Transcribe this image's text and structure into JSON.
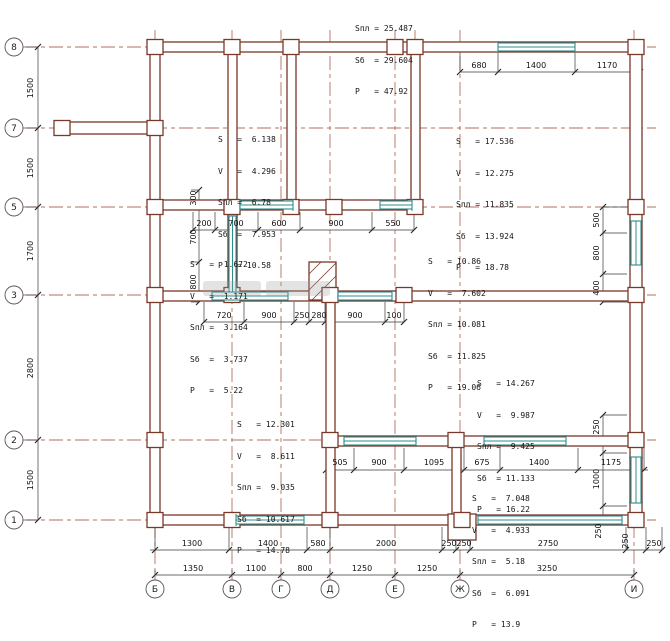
{
  "colors": {
    "wall": "#7a382a",
    "axis_line": "#b2705c",
    "window": "#2c8c8c",
    "dimension": "#3a3a3a"
  },
  "axes": {
    "left": [
      "8",
      "7",
      "5",
      "3",
      "2",
      "1"
    ],
    "bottom": [
      "Б",
      "В",
      "Г",
      "Д",
      "Е",
      "Ж",
      "И"
    ]
  },
  "dims": {
    "top": [
      "680",
      "1400",
      "1170"
    ],
    "row5": [
      "200",
      "700",
      "600",
      "900",
      "550"
    ],
    "row3": [
      "720",
      "900",
      "250",
      "280",
      "900",
      "100"
    ],
    "row2": [
      "505",
      "900",
      "1095",
      "675",
      "1400",
      "1175"
    ],
    "bottom1": [
      "1300",
      "1400",
      "580",
      "2000",
      "250",
      "250",
      "2750",
      "250"
    ],
    "bottom2": [
      "1350",
      "1100",
      "800",
      "1250",
      "1250",
      "3250"
    ],
    "left": [
      "1500",
      "1500",
      "1700",
      "2800",
      "1500"
    ],
    "leftMid": [
      "300",
      "700",
      "800"
    ],
    "rightTop": [
      "500",
      "800",
      "400"
    ],
    "rightBottom": [
      "250",
      "1000",
      "250"
    ],
    "rotE": "250"
  },
  "annotations": [
    {
      "name": "totals",
      "lines": [
        "Sпл = 25.487",
        "Sб  = 29.604",
        "P   = 47.92"
      ]
    },
    {
      "name": "room-1",
      "lines": [
        "S   =  6.138",
        "V   =  4.296",
        "Sпл =  6.78",
        "Sб  =  7.953",
        "P   = 10.58"
      ]
    },
    {
      "name": "room-2",
      "lines": [
        "S   = 17.536",
        "V   = 12.275",
        "Sпл = 11.835",
        "Sб  = 13.924",
        "P   = 18.78"
      ]
    },
    {
      "name": "room-3",
      "lines": [
        "S   =  1.672",
        "V   =  1.171",
        "Sпл =  3.164",
        "Sб  =  3.737",
        "P   =  5.22"
      ]
    },
    {
      "name": "room-4",
      "lines": [
        "S   = 10.86",
        "V   =  7.602",
        "Sпл = 10.081",
        "Sб  = 11.825",
        "P   = 19.06"
      ]
    },
    {
      "name": "room-5",
      "lines": [
        "S   = 14.267",
        "V   =  9.987",
        "Sпл =  9.425",
        "Sб  = 11.133",
        "P   = 16.22"
      ]
    },
    {
      "name": "room-6",
      "lines": [
        "S   = 12.301",
        "V   =  8.611",
        "Sпл =  9.035",
        "Sб  = 10.617",
        "P   = 14.78"
      ]
    },
    {
      "name": "room-7",
      "lines": [
        "S   =  7.048",
        "V   =  4.933",
        "Sпл =  5.18",
        "Sб  =  6.091",
        "P   = 13.9"
      ]
    }
  ]
}
